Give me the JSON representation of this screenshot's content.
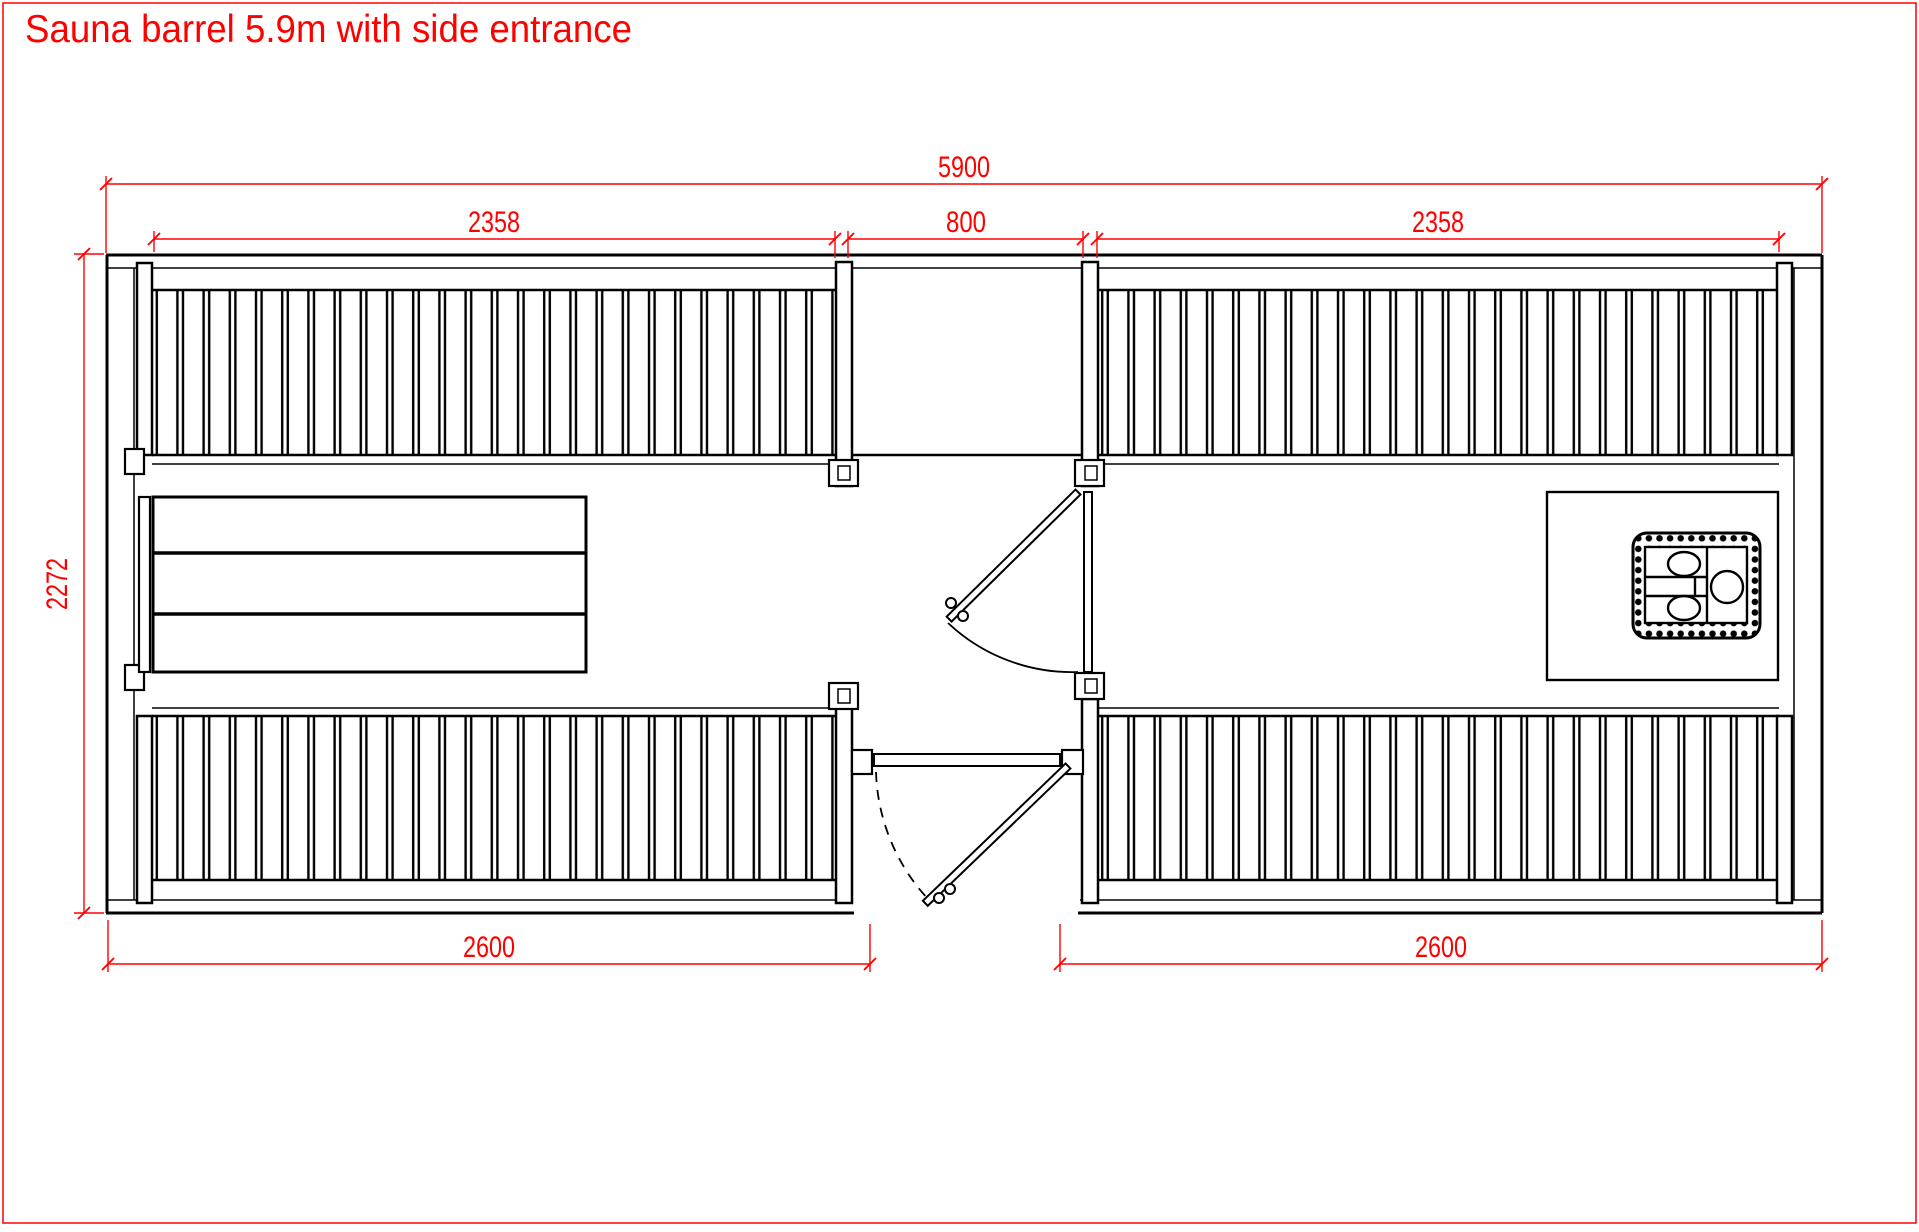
{
  "page": {
    "background": "#ffffff",
    "border_color": "#ff0000"
  },
  "title": "Sauna barrel 5.9m with side entrance",
  "drawing": {
    "type": "floor plan, top view",
    "units": "mm",
    "line_color": "#000000",
    "dimension_color": "#ff0000"
  },
  "dimensions": {
    "overall_length": "5900",
    "left_room_length": "2358",
    "entrance_width": "800",
    "right_room_length": "2358",
    "barrel_diameter": "2272",
    "left_floor_length": "2600",
    "right_floor_length": "2600"
  }
}
